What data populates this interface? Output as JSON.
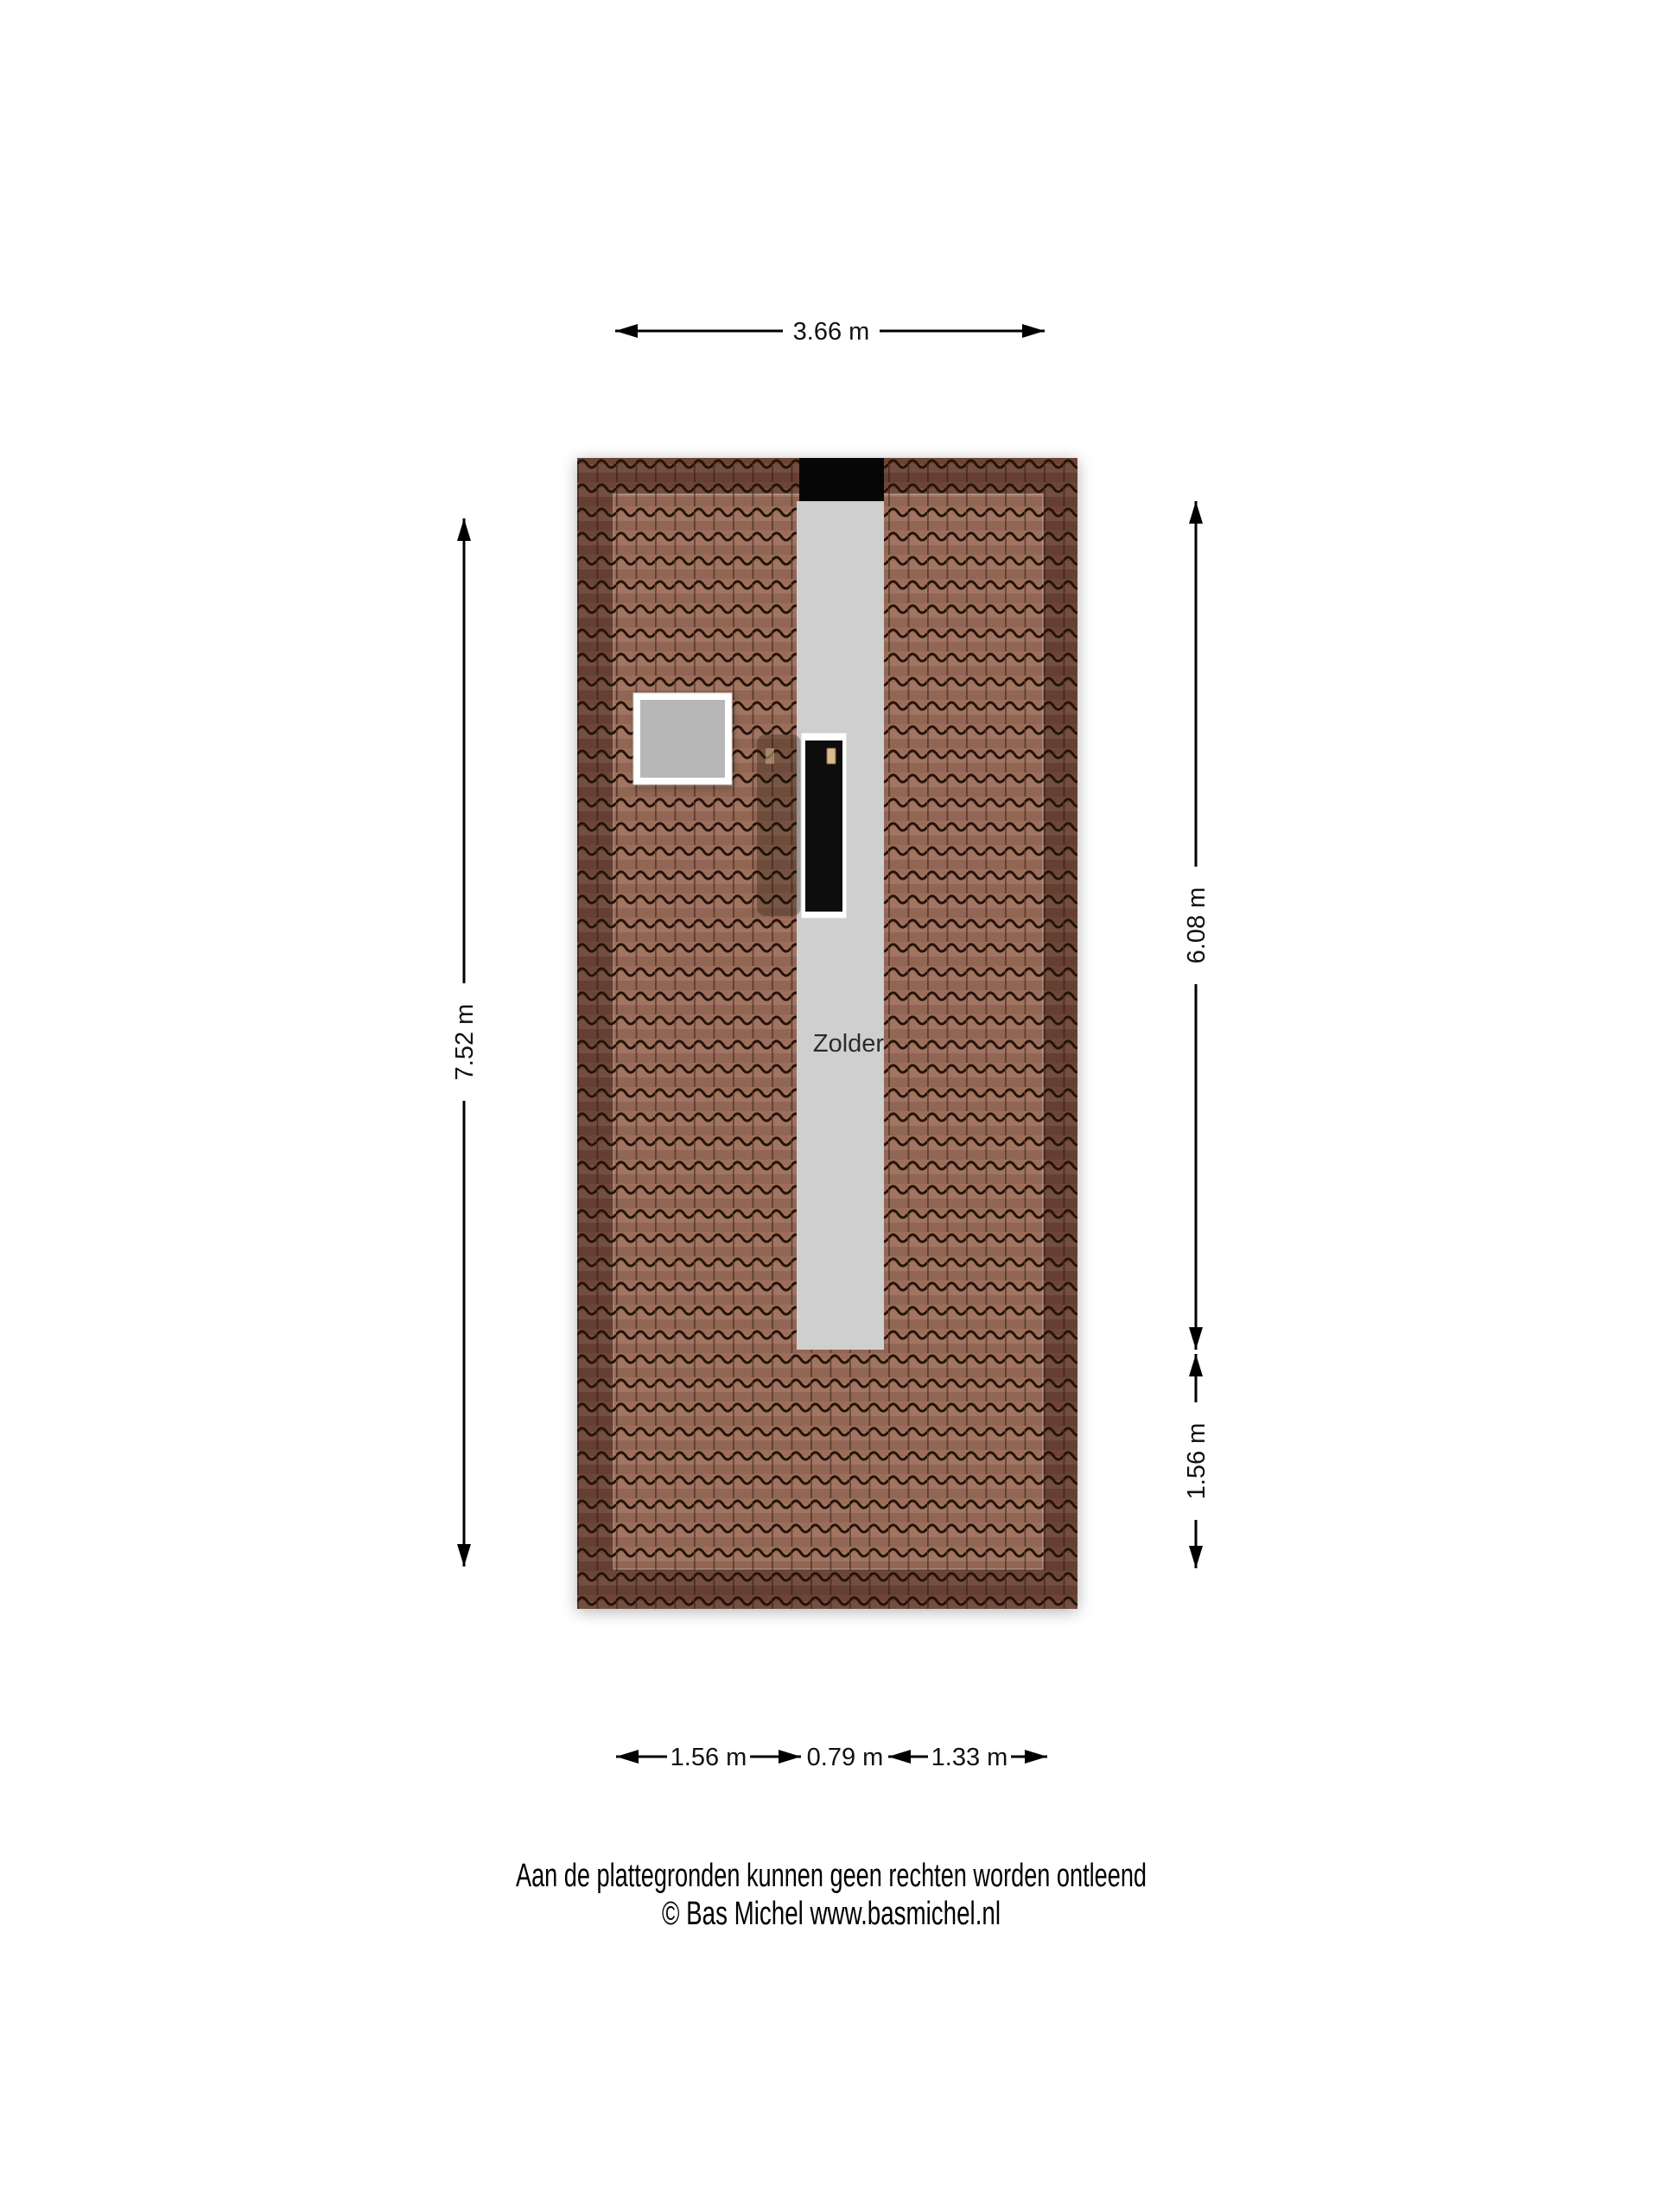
{
  "plan": {
    "room_label": "Zolder",
    "dimensions": {
      "top_width": "3.66 m",
      "left_height": "7.52 m",
      "right_upper": "6.08 m",
      "right_lower": "1.56 m",
      "bottom_left": "1.56 m",
      "bottom_middle": "0.79 m",
      "bottom_right": "1.33 m"
    },
    "colors": {
      "roof_outer": "#6d4536",
      "roof_inner": "#9c6e5a",
      "tile_line": "#24130a",
      "attic_floor": "#cfcfcf",
      "chimney": "#060606",
      "skylight_frame": "#ffffff",
      "skylight_glass": "#b7b7b7",
      "door_frame": "#ffffff",
      "door_panel": "#0d0d0d",
      "handle": "#d9bc8e"
    }
  },
  "footer": {
    "line1": "Aan de plattegronden kunnen geen rechten worden ontleend",
    "line2": "© Bas Michel www.basmichel.nl"
  }
}
